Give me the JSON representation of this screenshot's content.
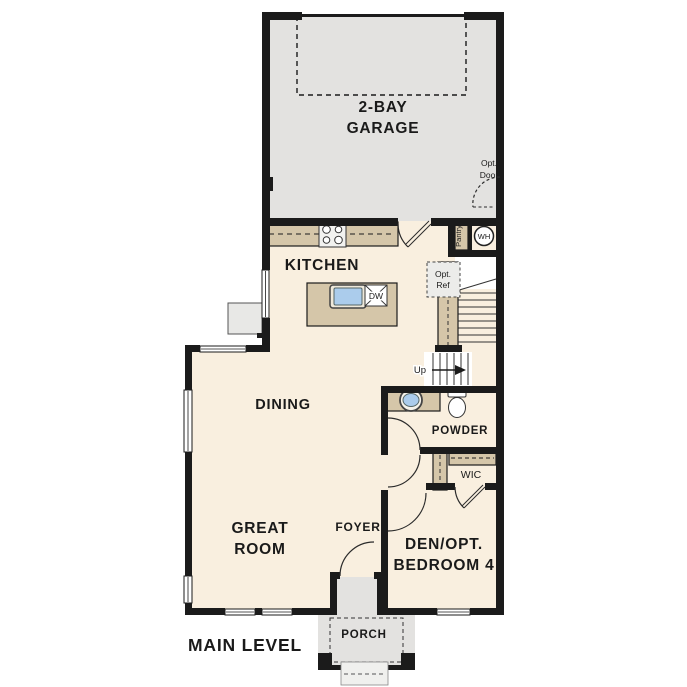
{
  "page": {
    "title": "MAIN LEVEL"
  },
  "palette": {
    "wall": "#1b1b1b",
    "floor": "#f9efdf",
    "garage_floor": "#e3e2e0",
    "counter": "#d5c6a9",
    "sink_water": "#abccec",
    "label_text": "#1a1a1a",
    "small_text": "#333333"
  },
  "rooms": {
    "garage": {
      "line1": "2-BAY",
      "line2": "GARAGE"
    },
    "kitchen": {
      "label": "KITCHEN"
    },
    "dining": {
      "label": "DINING"
    },
    "great_room": {
      "line1": "GREAT",
      "line2": "ROOM"
    },
    "foyer": {
      "label": "FOYER"
    },
    "powder": {
      "label": "POWDER"
    },
    "wic": {
      "label": "WIC"
    },
    "den": {
      "line1": "DEN/OPT.",
      "line2": "BEDROOM 4"
    },
    "porch": {
      "label": "PORCH"
    },
    "pantry": {
      "label": "Pantry"
    }
  },
  "annotations": {
    "level_title": "MAIN LEVEL",
    "opt_door": {
      "line1": "Opt.",
      "line2": "Door"
    },
    "opt_ref": {
      "line1": "Opt.",
      "line2": "Ref"
    },
    "water_heater": "WH",
    "dishwasher": "DW",
    "stairs_up": "Up"
  }
}
